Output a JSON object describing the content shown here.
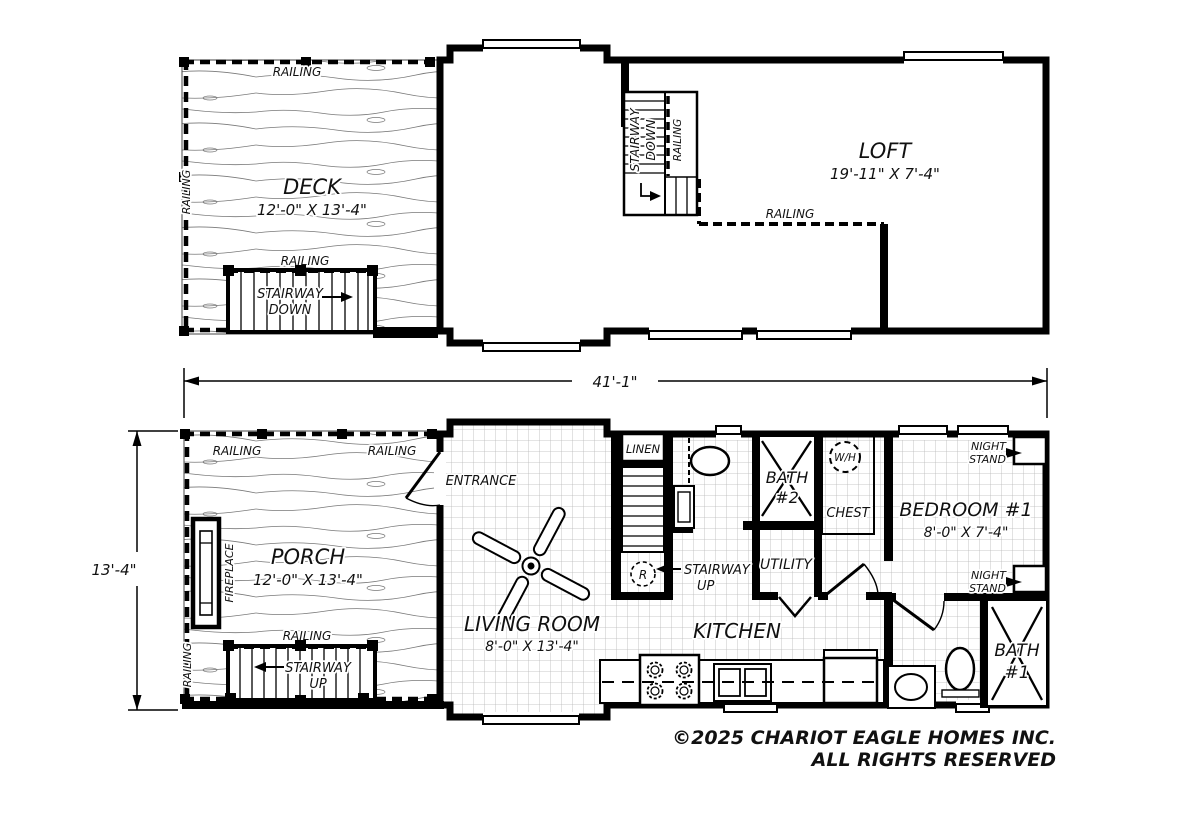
{
  "common": {
    "railing": "RAILING",
    "stairway": "STAIRWAY",
    "down": "DOWN",
    "up": "UP",
    "night": "NIGHT",
    "stand": "STAND"
  },
  "upper_floor": {
    "deck": {
      "name": "DECK",
      "size": "12'-0\" X 13'-4\""
    },
    "loft": {
      "name": "LOFT",
      "size": "19'-11\" X 7'-4\""
    }
  },
  "dimensions": {
    "overall_width": "41'-1\"",
    "overall_depth": "13'-4\""
  },
  "main_floor": {
    "porch": {
      "name": "PORCH",
      "size": "12'-0\" X 13'-4\""
    },
    "fireplace": "FIREPLACE",
    "entrance": "ENTRANCE",
    "living_room": {
      "name": "LIVING ROOM",
      "size": "8'-0\" X 13'-4\""
    },
    "linen": "LINEN",
    "r_symbol": "R",
    "bath2": {
      "line1": "BATH",
      "line2": "#2"
    },
    "water_heater": "W/H",
    "chest": "CHEST",
    "utility": "UTILITY",
    "kitchen": "KITCHEN",
    "bedroom1": {
      "name": "BEDROOM #1",
      "size": "8'-0\" X 7'-4\""
    },
    "bath1": {
      "line1": "BATH",
      "line2": "#1"
    }
  },
  "footer": {
    "line1": "©2025 CHARIOT EAGLE HOMES INC.",
    "line2": "ALL RIGHTS RESERVED"
  }
}
